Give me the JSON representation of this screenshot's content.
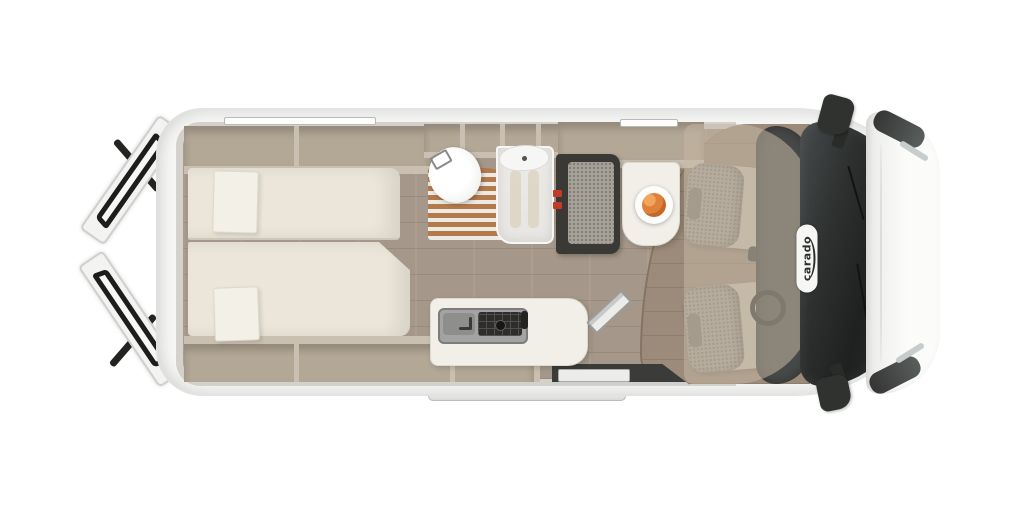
{
  "brand": {
    "logo_text": "carado"
  },
  "colors": {
    "bg": "#ffffff",
    "shell": "#f7f7f6",
    "wall": "#d4d1cc",
    "floor": "#a59789",
    "cabfloor": "#9c8b7a",
    "cabinet-in": "#b3a795",
    "cabinet-face": "#cac0b1",
    "cushion": "#ebe6d9",
    "pillow": "#f3f0e7",
    "seatdark": "#3b3936",
    "fabric": "#a5a199",
    "red": "#c23a28",
    "grate": "#b57a4c",
    "slat": "#eceae5",
    "porcelain": "#f6f6f4",
    "glass": "#e6e5e1",
    "counter": "#f1efe8",
    "hob": "#2e2d2b",
    "tint": "rgba(197,183,163,0.55)",
    "fruit": "#e0813a",
    "logo": "#2b2f2d"
  },
  "regions": [
    "rear-doors-open",
    "rear-bed",
    "overhead-shelves",
    "bathroom-toilet",
    "shower-grate",
    "shower-cubicle",
    "washbasin",
    "dinette-bench",
    "dinette-table",
    "fruit-plate",
    "kitchen-counter",
    "kitchen-sink",
    "gas-hob",
    "entry-step",
    "sliding-door-open",
    "driver-seat",
    "passenger-seat",
    "dashboard",
    "windshield",
    "hood",
    "headlights",
    "side-mirrors",
    "brand-badge"
  ]
}
